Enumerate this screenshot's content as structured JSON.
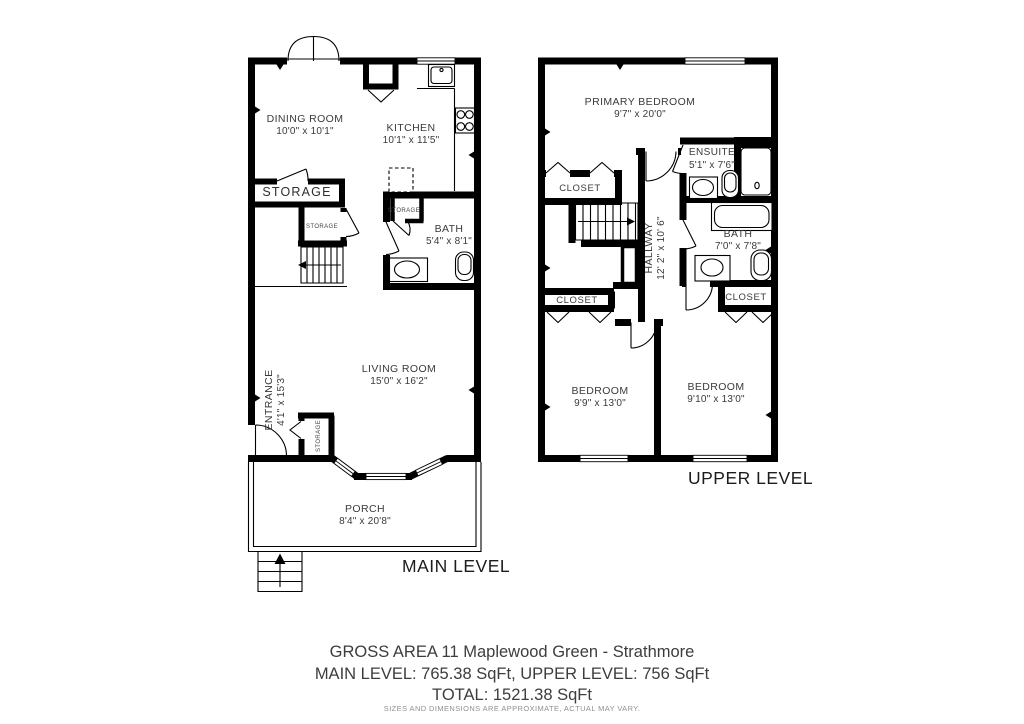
{
  "plan": {
    "main": {
      "level_label": "MAIN LEVEL",
      "dining": {
        "name": "DINING ROOM",
        "dims": "10'0\" x 10'1\""
      },
      "kitchen": {
        "name": "KITCHEN",
        "dims": "10'1\" x 11'5\""
      },
      "storage_room": {
        "name": "STORAGE"
      },
      "storage_under_stairs": {
        "name": "STORAGE"
      },
      "storage_bath": {
        "name": "STORAGE"
      },
      "storage_entry": {
        "name": "STORAGE"
      },
      "bath": {
        "name": "BATH",
        "dims": "5'4\" x 8'1\""
      },
      "living": {
        "name": "LIVING ROOM",
        "dims": "15'0\" x 16'2\""
      },
      "entrance": {
        "name": "ENTRANCE",
        "dims": "4'1\" x 15'3\""
      },
      "porch": {
        "name": "PORCH",
        "dims": "8'4\" x 20'8\""
      }
    },
    "upper": {
      "level_label": "UPPER LEVEL",
      "primary_bedroom": {
        "name": "PRIMARY BEDROOM",
        "dims": "9'7\" x 20'0\""
      },
      "ensuite": {
        "name": "ENSUITE",
        "dims": "5'1\" x 7'6\""
      },
      "closet_primary": {
        "name": "CLOSET"
      },
      "hallway": {
        "name": "HALLWAY",
        "dims": "12' 2\" x 10' 6\""
      },
      "bath": {
        "name": "BATH",
        "dims": "7'0\" x 7'8\""
      },
      "closet_bedroom_left": {
        "name": "CLOSET"
      },
      "closet_bedroom_right": {
        "name": "CLOSET"
      },
      "bedroom_left": {
        "name": "BEDROOM",
        "dims": "9'9\" x 13'0\""
      },
      "bedroom_right": {
        "name": "BEDROOM",
        "dims": "9'10\" x 13'0\""
      }
    },
    "colors": {
      "wall": "#000000",
      "label": "#3a3a3a",
      "disclaimer": "#909090"
    }
  },
  "footer": {
    "title": "GROSS AREA 11 Maplewood Green - Strathmore",
    "levels": "MAIN LEVEL: 765.38 SqFt, UPPER LEVEL: 756 SqFt",
    "total": "TOTAL: 1521.38 SqFt",
    "disclaimer": "SIZES AND DIMENSIONS ARE APPROXIMATE, ACTUAL MAY VARY."
  }
}
